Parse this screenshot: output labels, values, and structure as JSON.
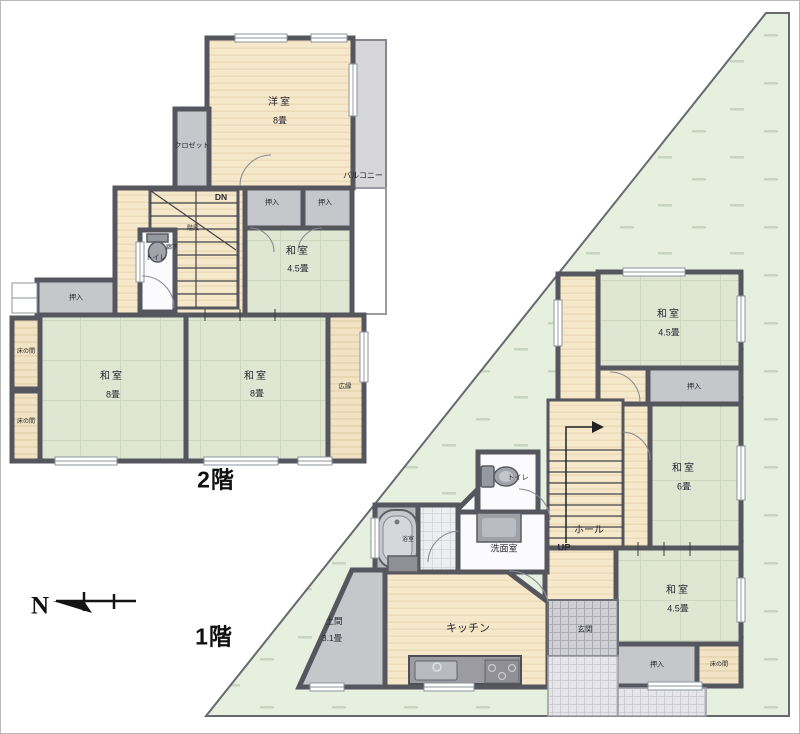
{
  "colors": {
    "wall": "#56565e",
    "label": "#26262e",
    "wood": "#f6e9cb",
    "wood-grain": "#e9d7b3",
    "tatami": "#dfe7d3",
    "tatami-seam": "#ccd7bd",
    "closet": "#c6c7cb",
    "tokonoma": "#f1e3c3",
    "tokonoma-grain": "#e0cda6",
    "white-room": "#fbfbfd",
    "bath": "#b7b8bc",
    "tile": "#eceef0",
    "tile-line": "#d3d4d8",
    "balcony": "#d7d7da",
    "lot": "#e7efdf",
    "lot-dash": "#c7d7bf",
    "lot-border": "#68686e",
    "genkan-dark": "#cfcfd4",
    "genkan-dark-line": "#a3a3ab",
    "genkan-light": "#e6e6ea",
    "genkan-light-line": "#c6c6cd"
  },
  "floor2": {
    "label": "2階",
    "yoshitsu": {
      "name": "洋室",
      "size": "8畳"
    },
    "closet": "クロゼット",
    "balcony": "バルコニー",
    "stairs_dn": "DN",
    "kaidan": "階段",
    "rouka": "廊下",
    "toilet": "トイレ",
    "oshiire_west": "押入",
    "oshiire_a": "押入",
    "oshiire_b": "押入",
    "washitsu45": {
      "name": "和室",
      "size": "4.5畳"
    },
    "washitsu8_west": {
      "name": "和室",
      "size": "8畳"
    },
    "washitsu8_east": {
      "name": "和室",
      "size": "8畳"
    },
    "tokonoma_a": "床の間",
    "tokonoma_b": "床の間",
    "hiroen": "広縁"
  },
  "floor1": {
    "label": "1階",
    "washitsu45_north": {
      "name": "和室",
      "size": "4.5畳"
    },
    "oshiire_north": "押入",
    "washitsu6": {
      "name": "和室",
      "size": "6畳"
    },
    "washitsu45_south": {
      "name": "和室",
      "size": "4.5畳"
    },
    "oshiire_south": "押入",
    "tokonoma": "床の間",
    "hall": "ホール",
    "stairs_up": "UP",
    "toilet": "トイレ",
    "washroom": "洗面室",
    "bath": "浴室",
    "kitchen": "キッチン",
    "doma": {
      "name": "土間",
      "size": "3.1畳"
    },
    "genkan": "玄関"
  },
  "compass": {
    "north": "N"
  }
}
